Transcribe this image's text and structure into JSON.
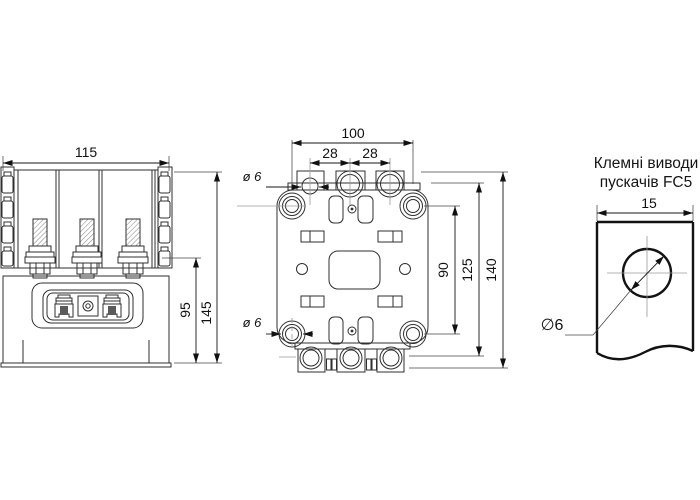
{
  "title": {
    "line1": "Клемні виводи",
    "line2": "пускачів FC5"
  },
  "front_view": {
    "width": "115",
    "overall_height": "145",
    "lower_height": "95"
  },
  "mounting_view": {
    "overall_width": "100",
    "pitch_left": "28",
    "pitch_right": "28",
    "top_hole_dia": "ø 6",
    "bottom_hole_dia": "ø 6",
    "hole_span": "90",
    "body_height": "125",
    "overall_height": "140"
  },
  "terminal_view": {
    "width": "15",
    "hole_dia": "∅6"
  }
}
